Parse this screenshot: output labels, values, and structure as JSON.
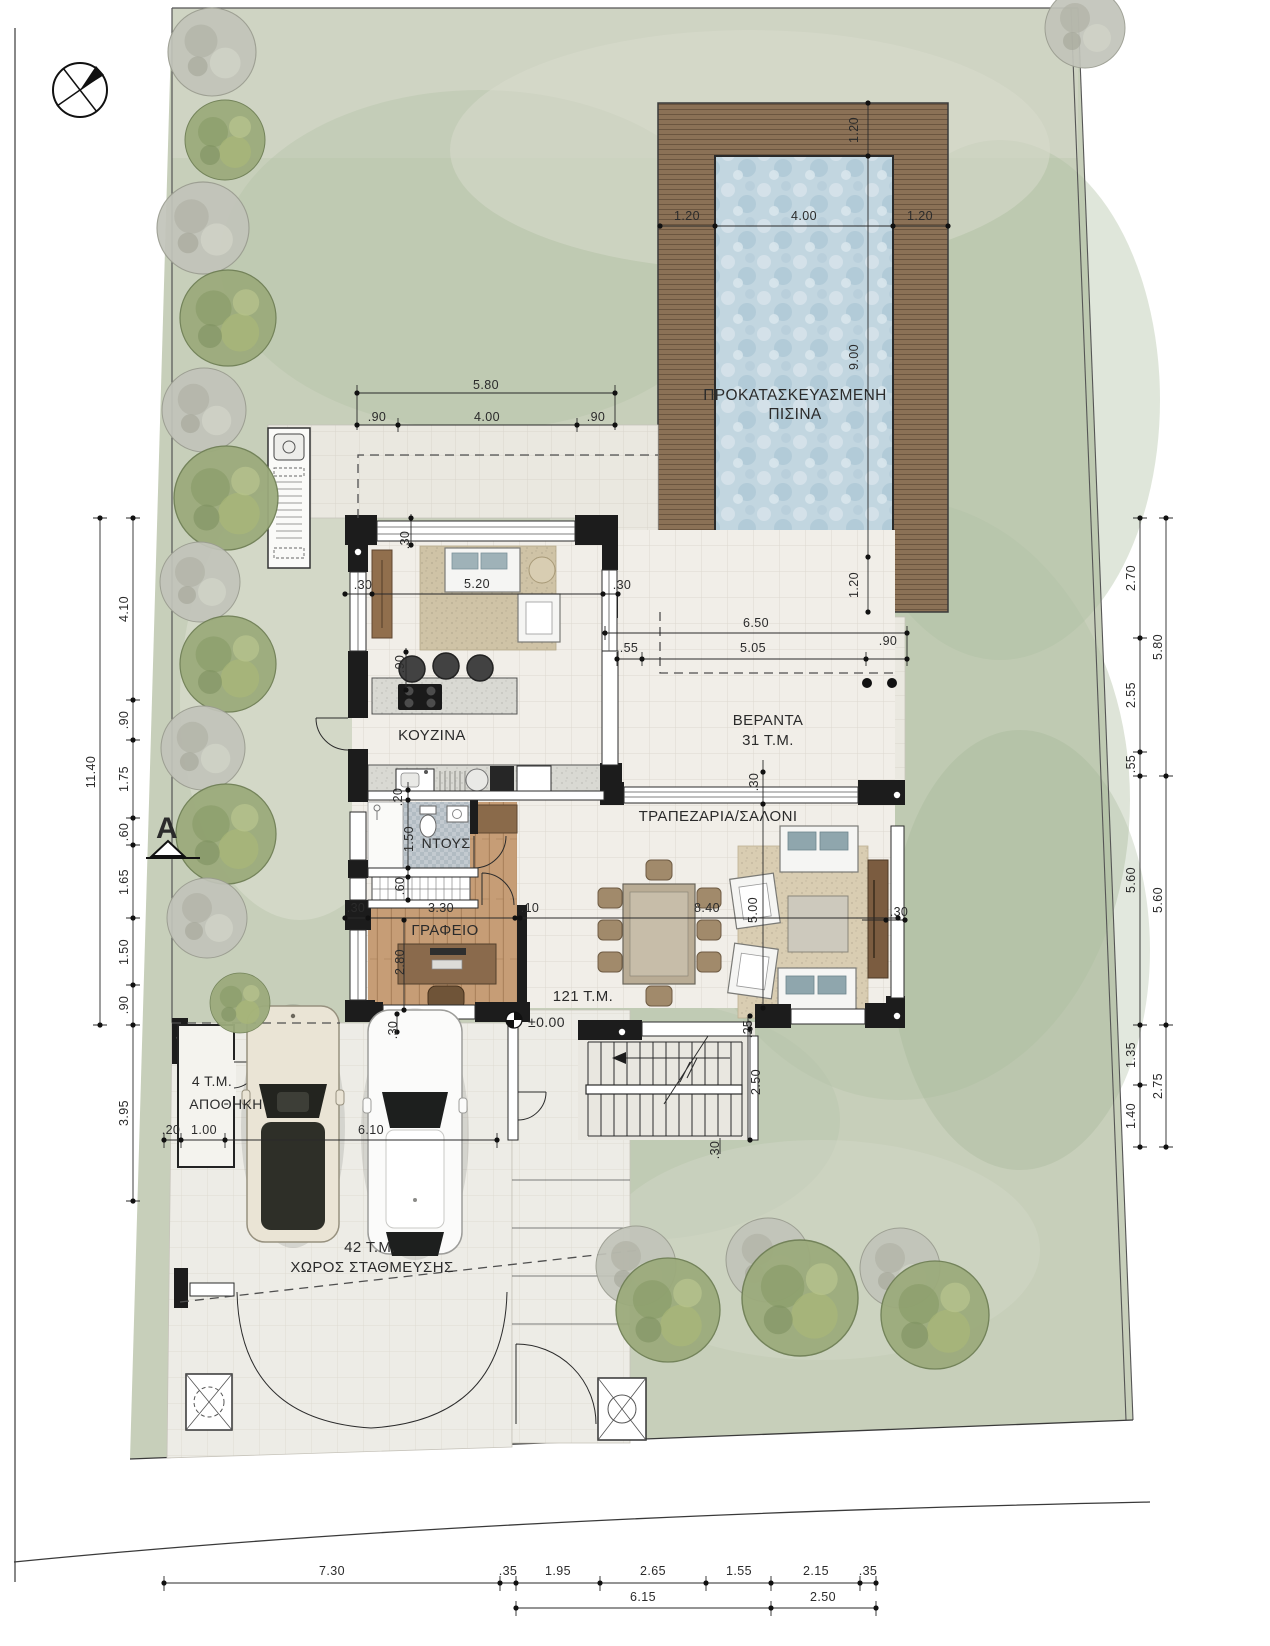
{
  "meta": {
    "drawing_type": "architectural site plan / ground floor plan",
    "language": "Greek",
    "units": "meters"
  },
  "colors": {
    "sheet": "#ffffff",
    "grass": "#c7cfba",
    "deck_wood": "#8b7156",
    "pool_water": "#c2d6e0",
    "wall": "#1c1c1c",
    "interior_tile": "#f1eee8",
    "outdoor_tile": "#eae8e0",
    "wood_floor": "#c69d76",
    "dim_text": "#222222"
  },
  "texts": {
    "room_labels": [
      {
        "name": "pool-title-line1",
        "t": "ΠΡΟΚΑΤΑΣΚΕΥΑΣΜΕΝΗ",
        "x": 795,
        "y": 400,
        "s": 15.5
      },
      {
        "name": "pool-title-line2",
        "t": "ΠΙΣΙΝΑ",
        "x": 795,
        "y": 419,
        "s": 15.5
      },
      {
        "name": "label-kitchen",
        "t": "ΚΟΥΖΙΝΑ",
        "x": 432,
        "y": 740,
        "s": 15
      },
      {
        "name": "label-shower",
        "t": "ΝΤΟΥΣ",
        "x": 446,
        "y": 848,
        "s": 14
      },
      {
        "name": "label-office",
        "t": "ΓΡΑΦΕΙΟ",
        "x": 445,
        "y": 935,
        "s": 15
      },
      {
        "name": "label-living-dining",
        "t": "ΤΡΑΠΕΖΑΡΙΑ/ΣΑΛΟΝΙ",
        "x": 718,
        "y": 821,
        "s": 15
      },
      {
        "name": "label-veranda",
        "t": "ΒΕΡΑΝΤΑ",
        "x": 768,
        "y": 725,
        "s": 15
      },
      {
        "name": "label-veranda-area",
        "t": "31 Τ.Μ.",
        "x": 768,
        "y": 745,
        "s": 15
      },
      {
        "name": "label-house-area",
        "t": "121 Τ.Μ.",
        "x": 583,
        "y": 1001,
        "s": 15
      },
      {
        "name": "label-floor-level",
        "t": "±0.00",
        "x": 528,
        "y": 1027,
        "s": 14,
        "a": "start"
      },
      {
        "name": "label-storage-area",
        "t": "4 Τ.Μ.",
        "x": 212,
        "y": 1086,
        "s": 14
      },
      {
        "name": "label-storage",
        "t": "ΑΠΟΘΗΚΗ",
        "x": 226,
        "y": 1109,
        "s": 14
      },
      {
        "name": "label-parking-area",
        "t": "42 Τ.Μ.",
        "x": 370,
        "y": 1252,
        "s": 15
      },
      {
        "name": "label-parking",
        "t": "ΧΩΡΟΣ ΣΤΑΘΜΕΥΣΗΣ",
        "x": 372,
        "y": 1272,
        "s": 15
      },
      {
        "name": "section-marker-letter",
        "t": "A",
        "x": 167,
        "y": 838,
        "s": 30,
        "w": "bold"
      }
    ],
    "dimensions": [
      {
        "t": "5.80",
        "x": 486,
        "y": 389
      },
      {
        "t": ".90",
        "x": 377,
        "y": 421
      },
      {
        "t": "4.00",
        "x": 487,
        "y": 421
      },
      {
        "t": ".90",
        "x": 596,
        "y": 421
      },
      {
        "t": "1.20",
        "x": 687,
        "y": 220
      },
      {
        "t": "4.00",
        "x": 804,
        "y": 220
      },
      {
        "t": "1.20",
        "x": 920,
        "y": 220
      },
      {
        "t": "1.20",
        "x": 858,
        "y": 130,
        "rot": -90
      },
      {
        "t": "9.00",
        "x": 858,
        "y": 357,
        "rot": -90
      },
      {
        "t": "1.20",
        "x": 858,
        "y": 585,
        "rot": -90
      },
      {
        "t": "6.50",
        "x": 756,
        "y": 627
      },
      {
        "t": ".55",
        "x": 629,
        "y": 652
      },
      {
        "t": "5.05",
        "x": 753,
        "y": 652
      },
      {
        "t": ".90",
        "x": 888,
        "y": 645
      },
      {
        "t": "11.40",
        "x": 95,
        "y": 772,
        "rot": -90
      },
      {
        "t": "4.10",
        "x": 128,
        "y": 609,
        "rot": -90
      },
      {
        "t": ".90",
        "x": 128,
        "y": 720,
        "rot": -90
      },
      {
        "t": "1.75",
        "x": 128,
        "y": 779,
        "rot": -90
      },
      {
        "t": ".60",
        "x": 128,
        "y": 832,
        "rot": -90
      },
      {
        "t": "1.65",
        "x": 128,
        "y": 882,
        "rot": -90
      },
      {
        "t": "1.50",
        "x": 128,
        "y": 952,
        "rot": -90
      },
      {
        "t": ".90",
        "x": 128,
        "y": 1005,
        "rot": -90
      },
      {
        "t": "3.95",
        "x": 128,
        "y": 1113,
        "rot": -90
      },
      {
        "t": "2.70",
        "x": 1135,
        "y": 578,
        "rot": -90
      },
      {
        "t": "2.55",
        "x": 1135,
        "y": 695,
        "rot": -90
      },
      {
        "t": ".55",
        "x": 1135,
        "y": 764,
        "rot": -90
      },
      {
        "t": "5.60",
        "x": 1135,
        "y": 880,
        "rot": -90
      },
      {
        "t": "1.35",
        "x": 1135,
        "y": 1055,
        "rot": -90
      },
      {
        "t": "1.40",
        "x": 1135,
        "y": 1116,
        "rot": -90
      },
      {
        "t": "5.80",
        "x": 1162,
        "y": 647,
        "rot": -90
      },
      {
        "t": "5.60",
        "x": 1162,
        "y": 900,
        "rot": -90
      },
      {
        "t": "2.75",
        "x": 1162,
        "y": 1086,
        "rot": -90
      },
      {
        "t": "7.30",
        "x": 332,
        "y": 1575
      },
      {
        "t": ".35",
        "x": 508,
        "y": 1575
      },
      {
        "t": "1.95",
        "x": 558,
        "y": 1575
      },
      {
        "t": "2.65",
        "x": 653,
        "y": 1575
      },
      {
        "t": "1.55",
        "x": 739,
        "y": 1575
      },
      {
        "t": "2.15",
        "x": 816,
        "y": 1575
      },
      {
        "t": ".35",
        "x": 868,
        "y": 1575
      },
      {
        "t": "6.15",
        "x": 643,
        "y": 1601
      },
      {
        "t": "2.50",
        "x": 823,
        "y": 1601
      },
      {
        "t": ".20",
        "x": 171,
        "y": 1134
      },
      {
        "t": "1.00",
        "x": 204,
        "y": 1134
      },
      {
        "t": "6.10",
        "x": 371,
        "y": 1134
      },
      {
        "t": "5.20",
        "x": 477,
        "y": 588
      },
      {
        "t": ".30",
        "x": 363,
        "y": 589
      },
      {
        "t": ".30",
        "x": 622,
        "y": 589
      },
      {
        "t": ".30",
        "x": 409,
        "y": 540,
        "rot": -90
      },
      {
        "t": ".90",
        "x": 404,
        "y": 664,
        "rot": -90
      },
      {
        "t": ".20",
        "x": 402,
        "y": 797,
        "rot": -90
      },
      {
        "t": "1.50",
        "x": 413,
        "y": 839,
        "rot": -90
      },
      {
        "t": ".60",
        "x": 404,
        "y": 886,
        "rot": -90
      },
      {
        "t": ".30",
        "x": 356,
        "y": 912
      },
      {
        "t": "3.30",
        "x": 441,
        "y": 912
      },
      {
        "t": ".10",
        "x": 530,
        "y": 912
      },
      {
        "t": "8.40",
        "x": 707,
        "y": 912
      },
      {
        "t": "2.80",
        "x": 404,
        "y": 962,
        "rot": -90
      },
      {
        "t": "5.00",
        "x": 757,
        "y": 910,
        "rot": -90
      },
      {
        "t": ".30",
        "x": 758,
        "y": 782,
        "rot": -90
      },
      {
        "t": ".30",
        "x": 899,
        "y": 916
      },
      {
        "t": ".25",
        "x": 752,
        "y": 1029,
        "rot": -90
      },
      {
        "t": "2.50",
        "x": 760,
        "y": 1082,
        "rot": -90
      },
      {
        "t": ".30",
        "x": 397,
        "y": 1030,
        "rot": -90
      },
      {
        "t": ".30",
        "x": 719,
        "y": 1150,
        "rot": -90
      }
    ]
  }
}
